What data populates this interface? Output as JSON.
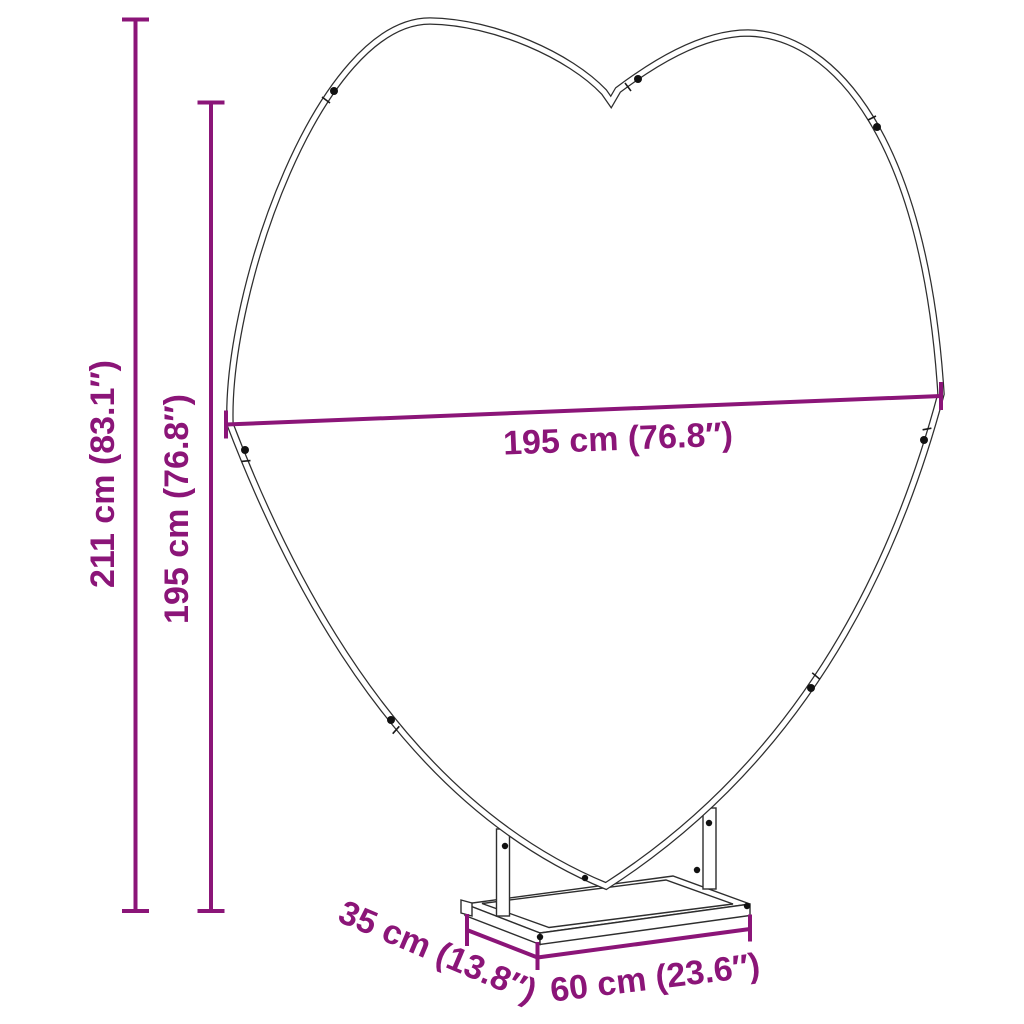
{
  "diagram": {
    "type": "product dimension drawing",
    "subject": "heart-shaped backdrop stand frame with rectangular base",
    "accent_color": "#8B1578",
    "outline_color": "#2E2E2E",
    "dimensions": {
      "total_height": "211 cm (83.1″)",
      "frame_height": "195 cm (76.8″)",
      "frame_width": "195 cm (76.8″)",
      "base_depth": "35 cm (13.8″)",
      "base_width": "60 cm (23.6″)"
    }
  }
}
